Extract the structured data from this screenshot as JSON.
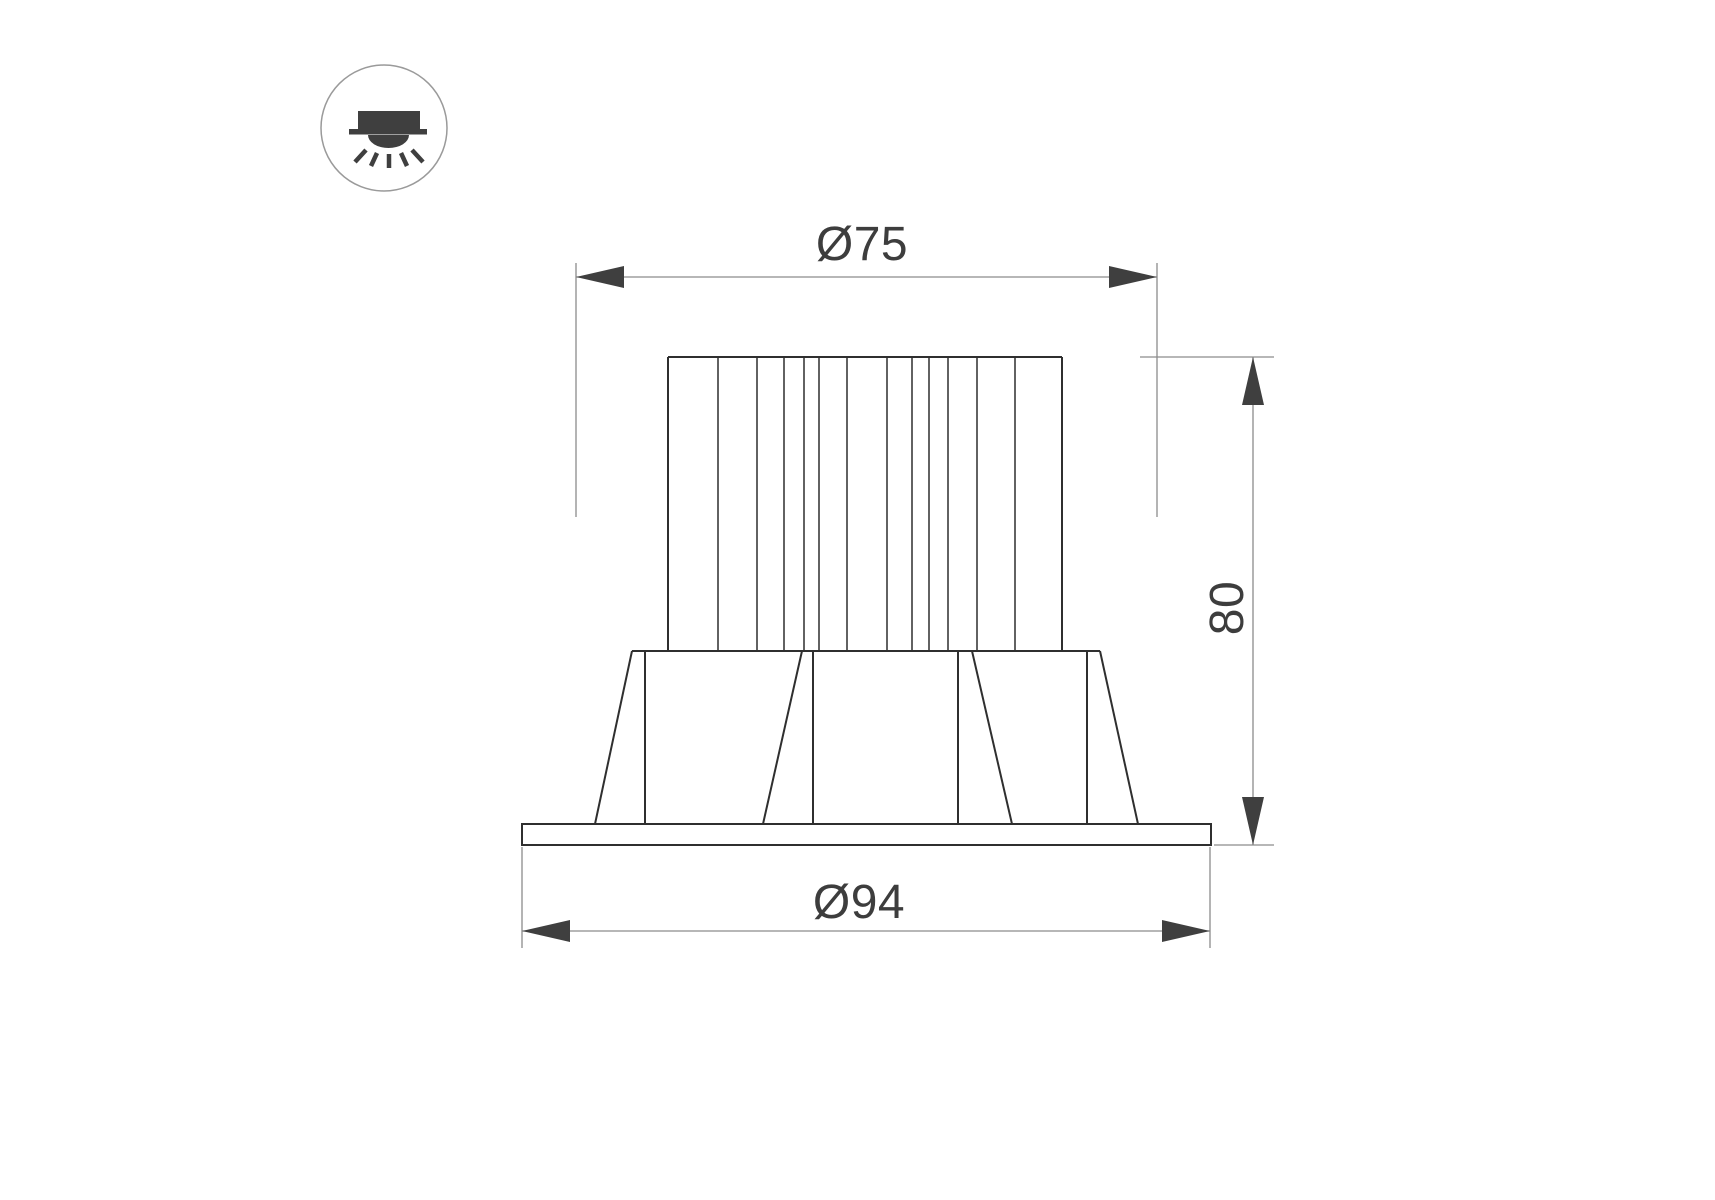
{
  "page": {
    "background": "#ffffff"
  },
  "icon": {
    "name": "recessed-downlight-icon"
  },
  "dimensions": {
    "top_diameter": {
      "label": "Ø75",
      "value": 75
    },
    "height": {
      "label": "80",
      "value": 80
    },
    "flange_diameter": {
      "label": "Ø94",
      "value": 94
    }
  },
  "colors": {
    "drawing_outline": "#2f2f2f",
    "dimension_lines": "#8c8c8c",
    "dimension_arrows": "#3f3f3f",
    "dimension_text": "#3d3d3d",
    "icon_symbol": "#3f3f3f",
    "icon_circle_border": "#9a9a9a"
  }
}
